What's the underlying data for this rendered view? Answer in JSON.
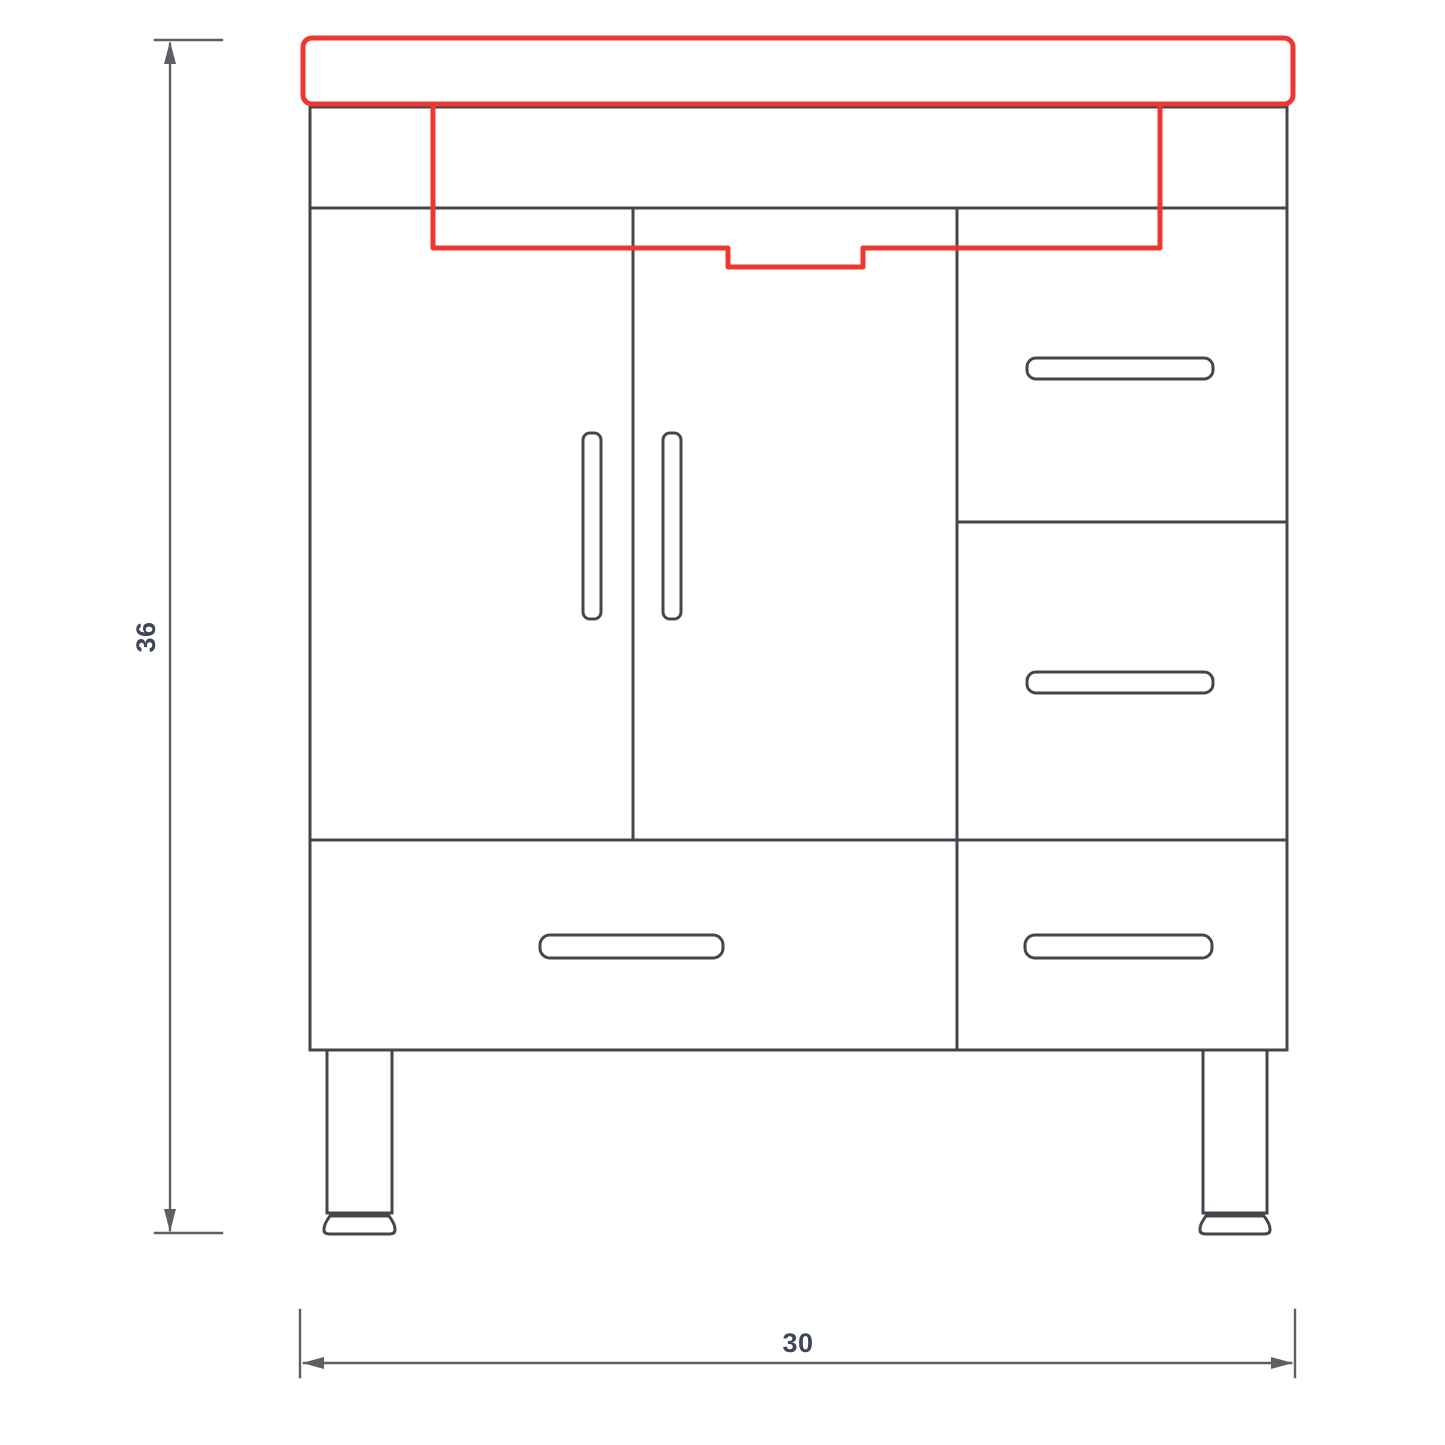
{
  "drawing": {
    "subject": "vanity-cabinet-front-elevation-technical-drawing",
    "background": "#ffffff",
    "colors": {
      "cabinet_outline": "#43464c",
      "sink_highlight": "#ee372f",
      "dimension_lines": "#5c5f63",
      "dimension_text": "#3e4657"
    },
    "dimensions": {
      "height_label": "36",
      "width_label": "30"
    }
  }
}
